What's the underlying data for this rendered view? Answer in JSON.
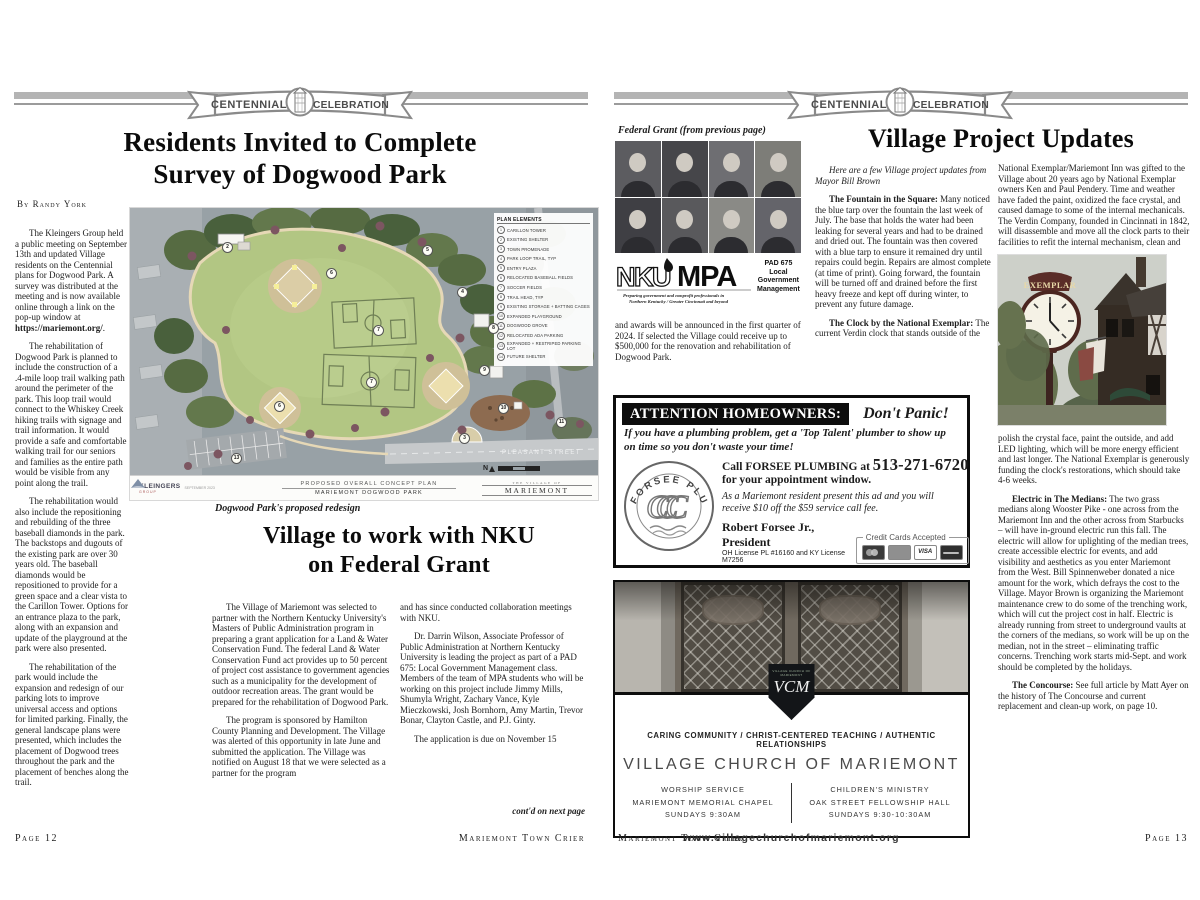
{
  "banner": {
    "left": "CENTENNIAL",
    "right": "CELEBRATION"
  },
  "page12": {
    "survey": {
      "title": [
        "Residents Invited to Complete",
        "Survey of Dogwood Park"
      ],
      "byline": "By Randy York",
      "p1a": "The Kleingers Group held a public meeting on September 13th and updated Village residents on the Centennial plans for Dogwood Park. A survey was distributed at the meeting and is now available online through a link on the pop-up window at ",
      "p1b": "https://mariemont.org/",
      "p1c": ".",
      "p2": "The rehabilitation of Dogwood Park is planned to include the construction of a .4-mile loop trail walking path around the perimeter of the park. This loop trail would connect to the Whiskey Creek hiking trails with signage and trail information. It would provide a safe and comfortable walking trail for our seniors and families as the entire path would be visible from any point along the trail.",
      "p3": "The rehabilitation would also include the repositioning and rebuilding of the three baseball diamonds in the park. The backstops and dugouts of the existing park are over 30 years old. The baseball diamonds would be repositioned to provide for a green space and a clear vista to the Carillon Tower. Options for an entrance plaza to the park, along with an expansion and update of the playground at the park were also presented.",
      "p4": "The rehabilitation of the park would include the expansion and redesign of our parking lots to improve universal access and options for limited parking. Finally, the general landscape plans were presented, which includes the placement of Dogwood trees throughout the park and the placement of benches along the trail."
    },
    "map": {
      "legend_title": "PLAN ELEMENTS",
      "legend": [
        {
          "n": "1",
          "label": "CARILLON TOWER"
        },
        {
          "n": "2",
          "label": "EXISTING SHELTER"
        },
        {
          "n": "3",
          "label": "TOWN PROMENADE"
        },
        {
          "n": "4",
          "label": "PARK LOOP TRAIL, TYP"
        },
        {
          "n": "5",
          "label": "ENTRY PLAZA"
        },
        {
          "n": "6",
          "label": "RELOCATED BASEBALL FIELDS"
        },
        {
          "n": "7",
          "label": "SOCCER FIELDS"
        },
        {
          "n": "8",
          "label": "TRAIL HEAD, TYP"
        },
        {
          "n": "9",
          "label": "EXISTING STORAGE + BATTING CAGES"
        },
        {
          "n": "10",
          "label": "EXPANDED PLAYGROUND"
        },
        {
          "n": "11",
          "label": "DOGWOOD GROVE"
        },
        {
          "n": "12",
          "label": "RELOCATED ADA PARKING"
        },
        {
          "n": "13",
          "label": "EXPANDED + RESTRIPED PARKING LOT"
        },
        {
          "n": "14",
          "label": "FUTURE SHELTER"
        }
      ],
      "markers": [
        "2",
        "6",
        "5",
        "4",
        "7",
        "8",
        "7",
        "6",
        "9",
        "10",
        "3",
        "11",
        "13"
      ],
      "street": "PLEASANT STREET",
      "plan_line1": "PROPOSED OVERALL CONCEPT PLAN",
      "plan_line2": "MARIEMONT DOGWOOD PARK",
      "firm": "KLEINGERS",
      "firm_sub": "GROUP",
      "firm_date": "SEPTEMBER 2023",
      "village_line1": "THE VILLAGE OF",
      "village_line2": "MARIEMONT",
      "north": "N",
      "caption": "Dogwood Park's proposed redesign"
    },
    "nku": {
      "title": [
        "Village to work with NKU",
        "on Federal Grant"
      ],
      "c1p1": "The Village of Mariemont was selected to partner with the Northern Kentucky University's Masters of Public Administration program in preparing a grant application for a Land & Water Conservation Fund. The federal Land & Water Conservation Fund act provides up to 50 percent of project cost assistance to government agencies such as a municipality for the development of outdoor recreation areas. The grant would be prepared for the rehabilitation of Dogwood Park.",
      "c1p2": "The program is sponsored by Hamilton County Planning and Development. The Village was alerted of this opportunity in late June and submitted the application. The Village was notified on August 18 that we were selected as a partner for the program",
      "c2p1": "and has since conducted collaboration meetings with NKU.",
      "c2p2": "Dr. Darrin Wilson, Associate Professor of Public Administration at Northern Kentucky University is leading the project as part of a PAD 675: Local Government Management class. Members of the team of MPA students who will be working on this project include Jimmy Mills, Shumyla Wright, Zachary Vance, Kyle Mieczkowski, Josh Bornhorn, Amy Martin, Trevor Bonar, Clayton Castle, and P.J. Ginty.",
      "c2p3": "The application is due on November 15",
      "contd": "cont'd on next page"
    },
    "footer": {
      "page": "Page 12",
      "publication": "Mariemont Town Crier"
    }
  },
  "page13": {
    "fedgrant": {
      "caption": "Federal Grant (from previous page)",
      "logo_nku": "NKU",
      "logo_mpa": "MPA",
      "logo_tagline1": "Preparing government and nonprofit professionals in",
      "logo_tagline2": "Northern Kentucky / Greater Cincinnati and beyond",
      "pad": [
        "PAD 675",
        "Local",
        "Government",
        "Management"
      ],
      "text": "and awards will be announced in the first quarter of 2024. If selected the Village could receive up to $500,000 for the renovation and rehabilitation of Dogwood Park."
    },
    "updates": {
      "title": "Village Project Updates",
      "intro": "Here are a few Village project updates from Mayor Bill Brown",
      "fountain_lead": "The Fountain in the Square:",
      "fountain_text": "Many noticed the blue tarp over the fountain the last week of July. The base that holds the water had been leaking for several years and had to be drained and dried out. The fountain was then covered with a blue tarp to ensure it remained dry until repairs could begin. Repairs are almost complete (at time of print). Going forward, the fountain will be turned off and drained before the first heavy freeze and kept off during winter, to prevent any future damage.",
      "clock_lead": "The Clock by the National Exemplar:",
      "clock_text": "The current Verdin clock that stands outside of the",
      "col2a": "National Exemplar/Mariemont Inn was gifted to the Village about 20 years ago by National Exemplar owners Ken and Paul Pendery. Time and weather have faded the paint, oxidized the face crystal, and caused damage to some of the internal mechanicals. The Verdin Company, founded in Cincinnati in 1842, will disassemble and move all the clock parts to their facilities to refit the internal mechanism, clean and",
      "clock_sign": "EXEMPLAR",
      "col2b": "polish the crystal face, paint the outside, and add LED lighting, which will be more energy efficient and last longer. The National Exemplar is generously funding the clock's restorations, which should take 4-6 weeks.",
      "electric_lead": "Electric in The Medians:",
      "electric_text": "The two grass medians along Wooster Pike - one across from the Mariemont Inn and the other across from Starbucks – will have in-ground electric run this fall. The electric will allow for uplighting of the median trees, create accessible electric for events, and add visibility and aesthetics as you enter Mariemont from the West. Bill Spinnenweber donated a nice amount for the work, which defrays the cost to the Village. Mayor Brown is organizing the Mariemont maintenance crew to do some of the trenching work, which will cut the project cost in half. Electric is already running from street to underground vaults at the corners of the medians, so work will be up on the median, not in the street – eliminating traffic concerns. Trenching work starts mid-Sept. and work should be completed by the holidays.",
      "concourse_lead": "The Concourse:",
      "concourse_text": "See full article by Matt Ayer on the history of The Concourse and current replacement and clean-up work, on page 10."
    },
    "plumbing_ad": {
      "header": "ATTENTION HOMEOWNERS:",
      "panic": "Don't Panic!",
      "tagline": "If you have a plumbing problem,  get a 'Top Talent' plumber to show up on time so you don't waste your time!",
      "logo_arc": "FORSEE PLUMBING",
      "logo_monogram": "CCC",
      "call_pre": "Call FORSEE PLUMBING at",
      "phone": "513-271-6720",
      "call_post": "for your appointment window.",
      "offer": "As a Mariemont resident present this ad and you will receive $10 off the $59 service call fee.",
      "president": "Robert Forsee Jr., President",
      "license": "OH License PL #16160 and KY License M7256",
      "cc_label": "Credit Cards Accepted",
      "visa": "VISA"
    },
    "church_ad": {
      "crest": "VCM",
      "crest_caption": "VILLAGE CHURCH OF MARIEMONT",
      "values": "CARING COMMUNITY / CHRIST-CENTERED TEACHING / AUTHENTIC RELATIONSHIPS",
      "name": "VILLAGE CHURCH OF MARIEMONT",
      "left_col": [
        "WORSHIP SERVICE",
        "MARIEMONT MEMORIAL CHAPEL",
        "SUNDAYS 9:30AM"
      ],
      "right_col": [
        "CHILDREN'S MINISTRY",
        "OAK STREET FELLOWSHIP HALL",
        "SUNDAYS 9:30-10:30AM"
      ],
      "url": "www.villagechurchofmariemont.org"
    },
    "footer": {
      "publication": "Mariemont Town Crier",
      "page": "Page 13"
    }
  }
}
